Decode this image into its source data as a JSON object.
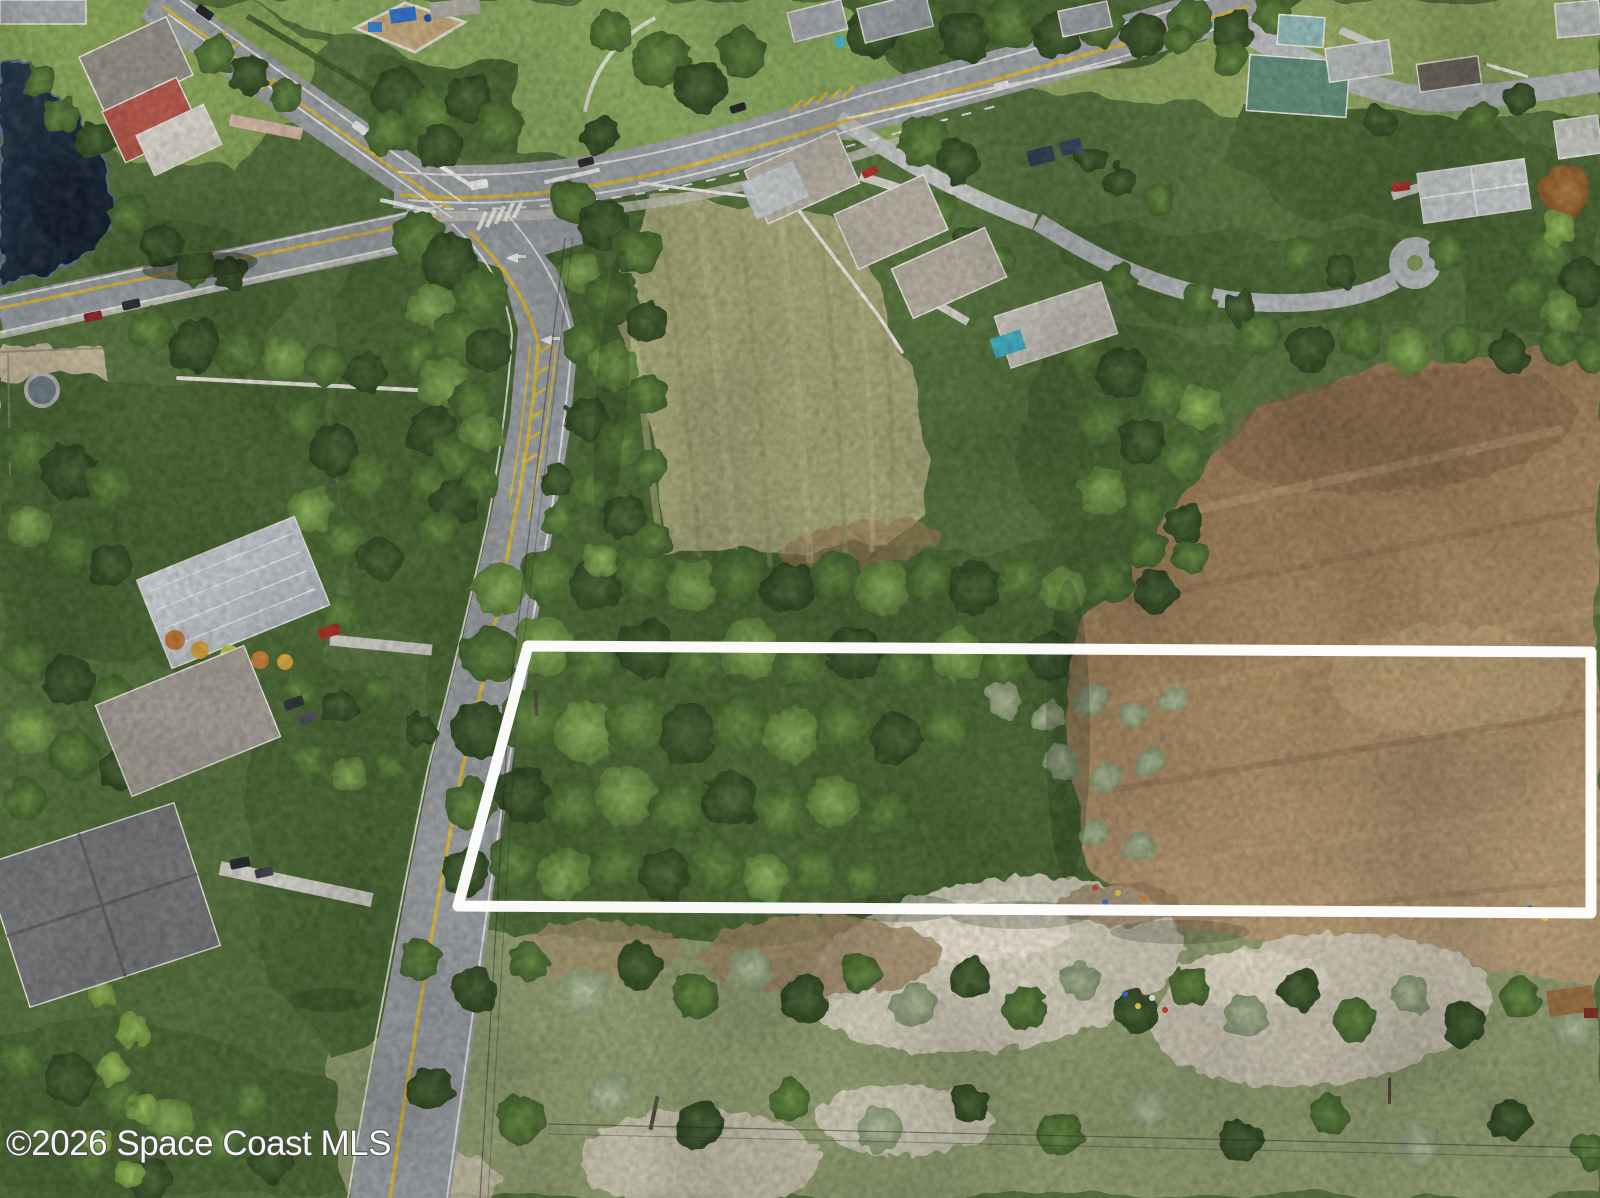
{
  "watermark": {
    "text": "©2026 Space Coast MLS",
    "color": "#ffffff",
    "outline": "#4a4a4a"
  },
  "property_outline": {
    "color": "#ffffff",
    "stroke_width": 11,
    "points_attr": "528,646 1591,652 1591,913 458,906"
  },
  "scene": {
    "description": "Aerial drone photo: vacant wooded parcel outlined in white along a curving two-lane road; intersection, pond, park and houses at top; dry brown field at right; sandy scrub at bottom.",
    "palette": {
      "canopy": "#4a6533",
      "tree_light": "#8db55c",
      "field_green": "#a6a878",
      "field_brown": "#a8895f",
      "pond": "#1d2b3a",
      "asphalt": "#9ba0a3",
      "sand": "#d6cfbe",
      "lawn": "#86a259",
      "pool": "#41b2c6",
      "outline": "#ffffff"
    }
  }
}
